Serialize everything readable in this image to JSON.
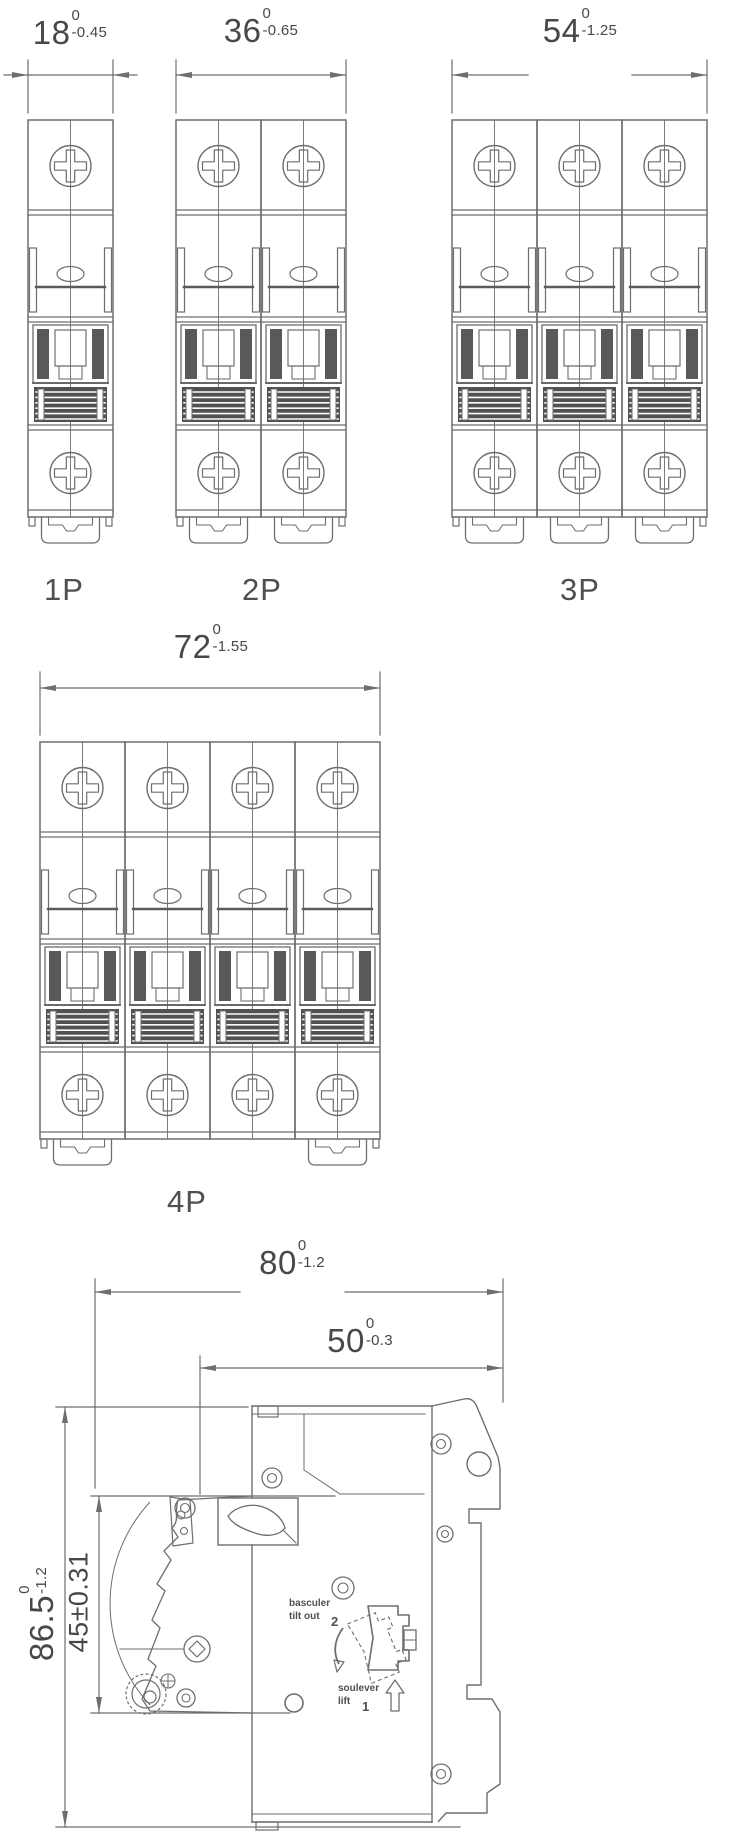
{
  "drawing": {
    "line_color": "#6e6e6e",
    "dark_color": "#515151",
    "text_color": "#484848",
    "background": "#ffffff"
  },
  "front_views": [
    {
      "label": "1P",
      "poles": 1,
      "clips": [
        1
      ],
      "dimension": {
        "value": "18",
        "tol_upper": "0",
        "tol_lower": "-0.45"
      }
    },
    {
      "label": "2P",
      "poles": 2,
      "clips": [
        1,
        2
      ],
      "dimension": {
        "value": "36",
        "tol_upper": "0",
        "tol_lower": "-0.65"
      }
    },
    {
      "label": "3P",
      "poles": 3,
      "clips": [
        1,
        2,
        3
      ],
      "dimension": {
        "value": "54",
        "tol_upper": "0",
        "tol_lower": "-1.25"
      }
    },
    {
      "label": "4P",
      "poles": 4,
      "clips": [
        1,
        4
      ],
      "dimension": {
        "value": "72",
        "tol_upper": "0",
        "tol_lower": "-1.55"
      }
    }
  ],
  "side_view": {
    "dimensions": {
      "overall_depth": {
        "value": "80",
        "tol_upper": "0",
        "tol_lower": "-1.2"
      },
      "body_depth": {
        "value": "50",
        "tol_upper": "0",
        "tol_lower": "-0.3"
      },
      "overall_height": {
        "value": "86.5",
        "tol_upper": "0",
        "tol_lower": "-1.2"
      },
      "handle_height": {
        "value": "45±0.31"
      }
    },
    "mounting_steps": [
      {
        "step": "2",
        "label_line1": "basculer",
        "label_line2": "tilt out"
      },
      {
        "step": "1",
        "label_line1": "soulever",
        "label_line2": "lift"
      }
    ]
  }
}
